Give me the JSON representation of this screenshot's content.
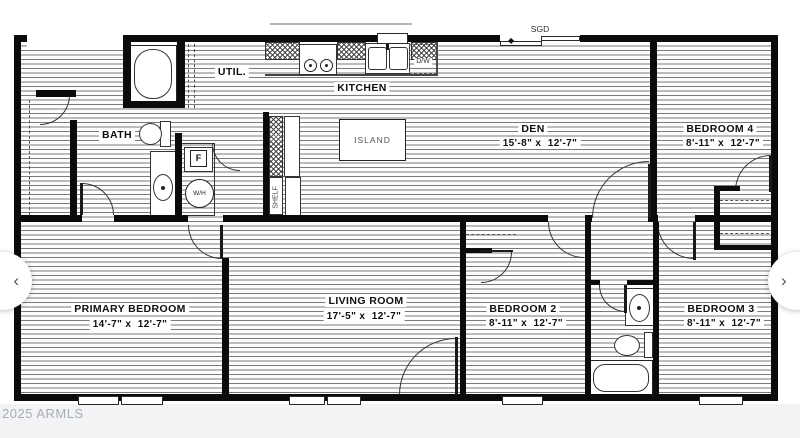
{
  "watermark": "2025 ARMLS",
  "nav": {
    "prev": "‹",
    "next": "›"
  },
  "rooms": {
    "kitchen": {
      "name": "KITCHEN"
    },
    "util": {
      "name": "UTIL."
    },
    "bath": {
      "name": "BATH"
    },
    "den": {
      "name": "DEN",
      "dims": "15'-8\" x  12'-7\""
    },
    "bedroom4": {
      "name": "BEDROOM 4",
      "dims": "8'-11\" x  12'-7\""
    },
    "primary_bedroom": {
      "name": "PRIMARY BEDROOM",
      "dims": "14'-7\" x  12'-7\""
    },
    "living_room": {
      "name": "LIVING ROOM",
      "dims": "17'-5\" x  12'-7\""
    },
    "bedroom2": {
      "name": "BEDROOM 2",
      "dims": "8'-11\" x  12'-7\""
    },
    "bedroom3": {
      "name": "BEDROOM 3",
      "dims": "8'-11\" x  12'-7\""
    }
  },
  "fixtures": {
    "sgd": "SGD",
    "dw": "D/W",
    "island": "ISLAND",
    "shelf": "SHELF",
    "furnace": "F",
    "water_heater": "W/H",
    "slider_marker": "◆"
  }
}
